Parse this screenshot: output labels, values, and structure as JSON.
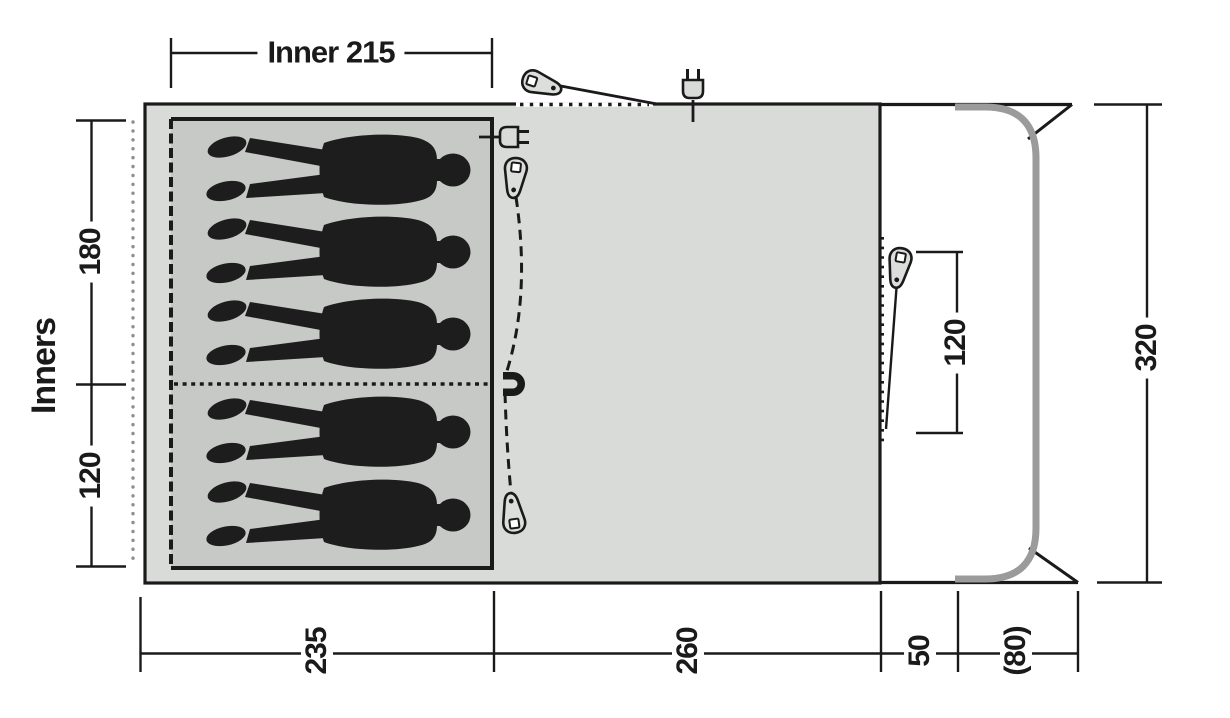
{
  "diagram": {
    "type": "tent-floorplan",
    "sleepers_shown": 5
  },
  "labels": {
    "inner_width": "Inner 215",
    "side": "Inners",
    "depth_top": "180",
    "depth_bottom": "120",
    "total_depth": "320",
    "front_door": "120",
    "bottom_inner": "235",
    "bottom_living": "260",
    "bottom_front": "50",
    "bottom_canopy": "(80)"
  },
  "icons": {
    "zipper_pull": "zipper-pull-icon",
    "power_plug": "power-plug-icon",
    "magnet": "magnet-tieback-icon",
    "sleeper": "sleeper-silhouette"
  },
  "colors": {
    "outline": "#1a1a1a",
    "tent_fill": "#d9dbd9",
    "inner_fill": "#c7c9c7",
    "pole_gray": "#9b9b9b",
    "dot_gray": "#8f8f8f",
    "background": "#ffffff"
  }
}
